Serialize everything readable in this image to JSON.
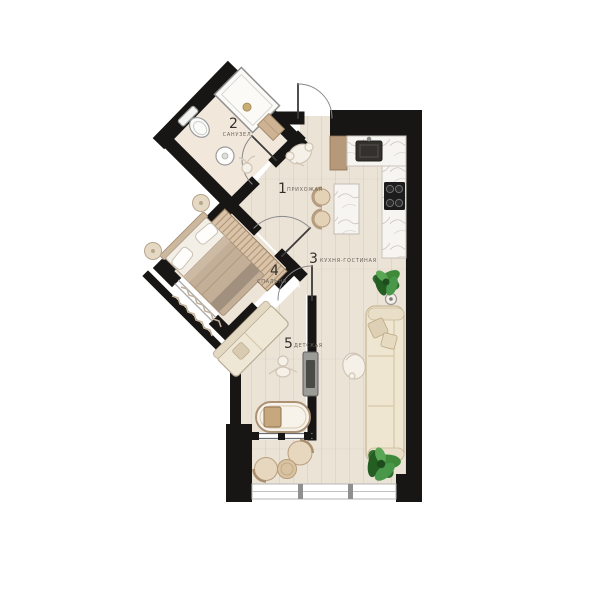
{
  "plan": {
    "title": "apartment-floor-plan",
    "rooms": [
      {
        "number": "1",
        "name": "ПРИХОЖАЯ"
      },
      {
        "number": "2",
        "name": "САНУЗЕЛ"
      },
      {
        "number": "3",
        "name": "КУХНЯ-ГОСТИНАЯ"
      },
      {
        "number": "4",
        "name": "СПАЛЬНЯ"
      },
      {
        "number": "5",
        "name": "ДЕТСКАЯ"
      }
    ],
    "colors": {
      "wall": "#171614",
      "floor": "#ece3d7",
      "floor_bath": "#f1e7db",
      "floor_bedroom": "#ede4d8",
      "floor_children": "#ece2d6",
      "marble": "#f7f5f2",
      "wood": "#b6987a",
      "wardrobe_stripe": "#d9c4ab",
      "sofa_cream": "#efe6d2",
      "blanket": "#c3ae97",
      "appliance_black": "#1c1c1c",
      "plant_green": "#316e2e",
      "window_frame": "#a9a9a9"
    }
  }
}
